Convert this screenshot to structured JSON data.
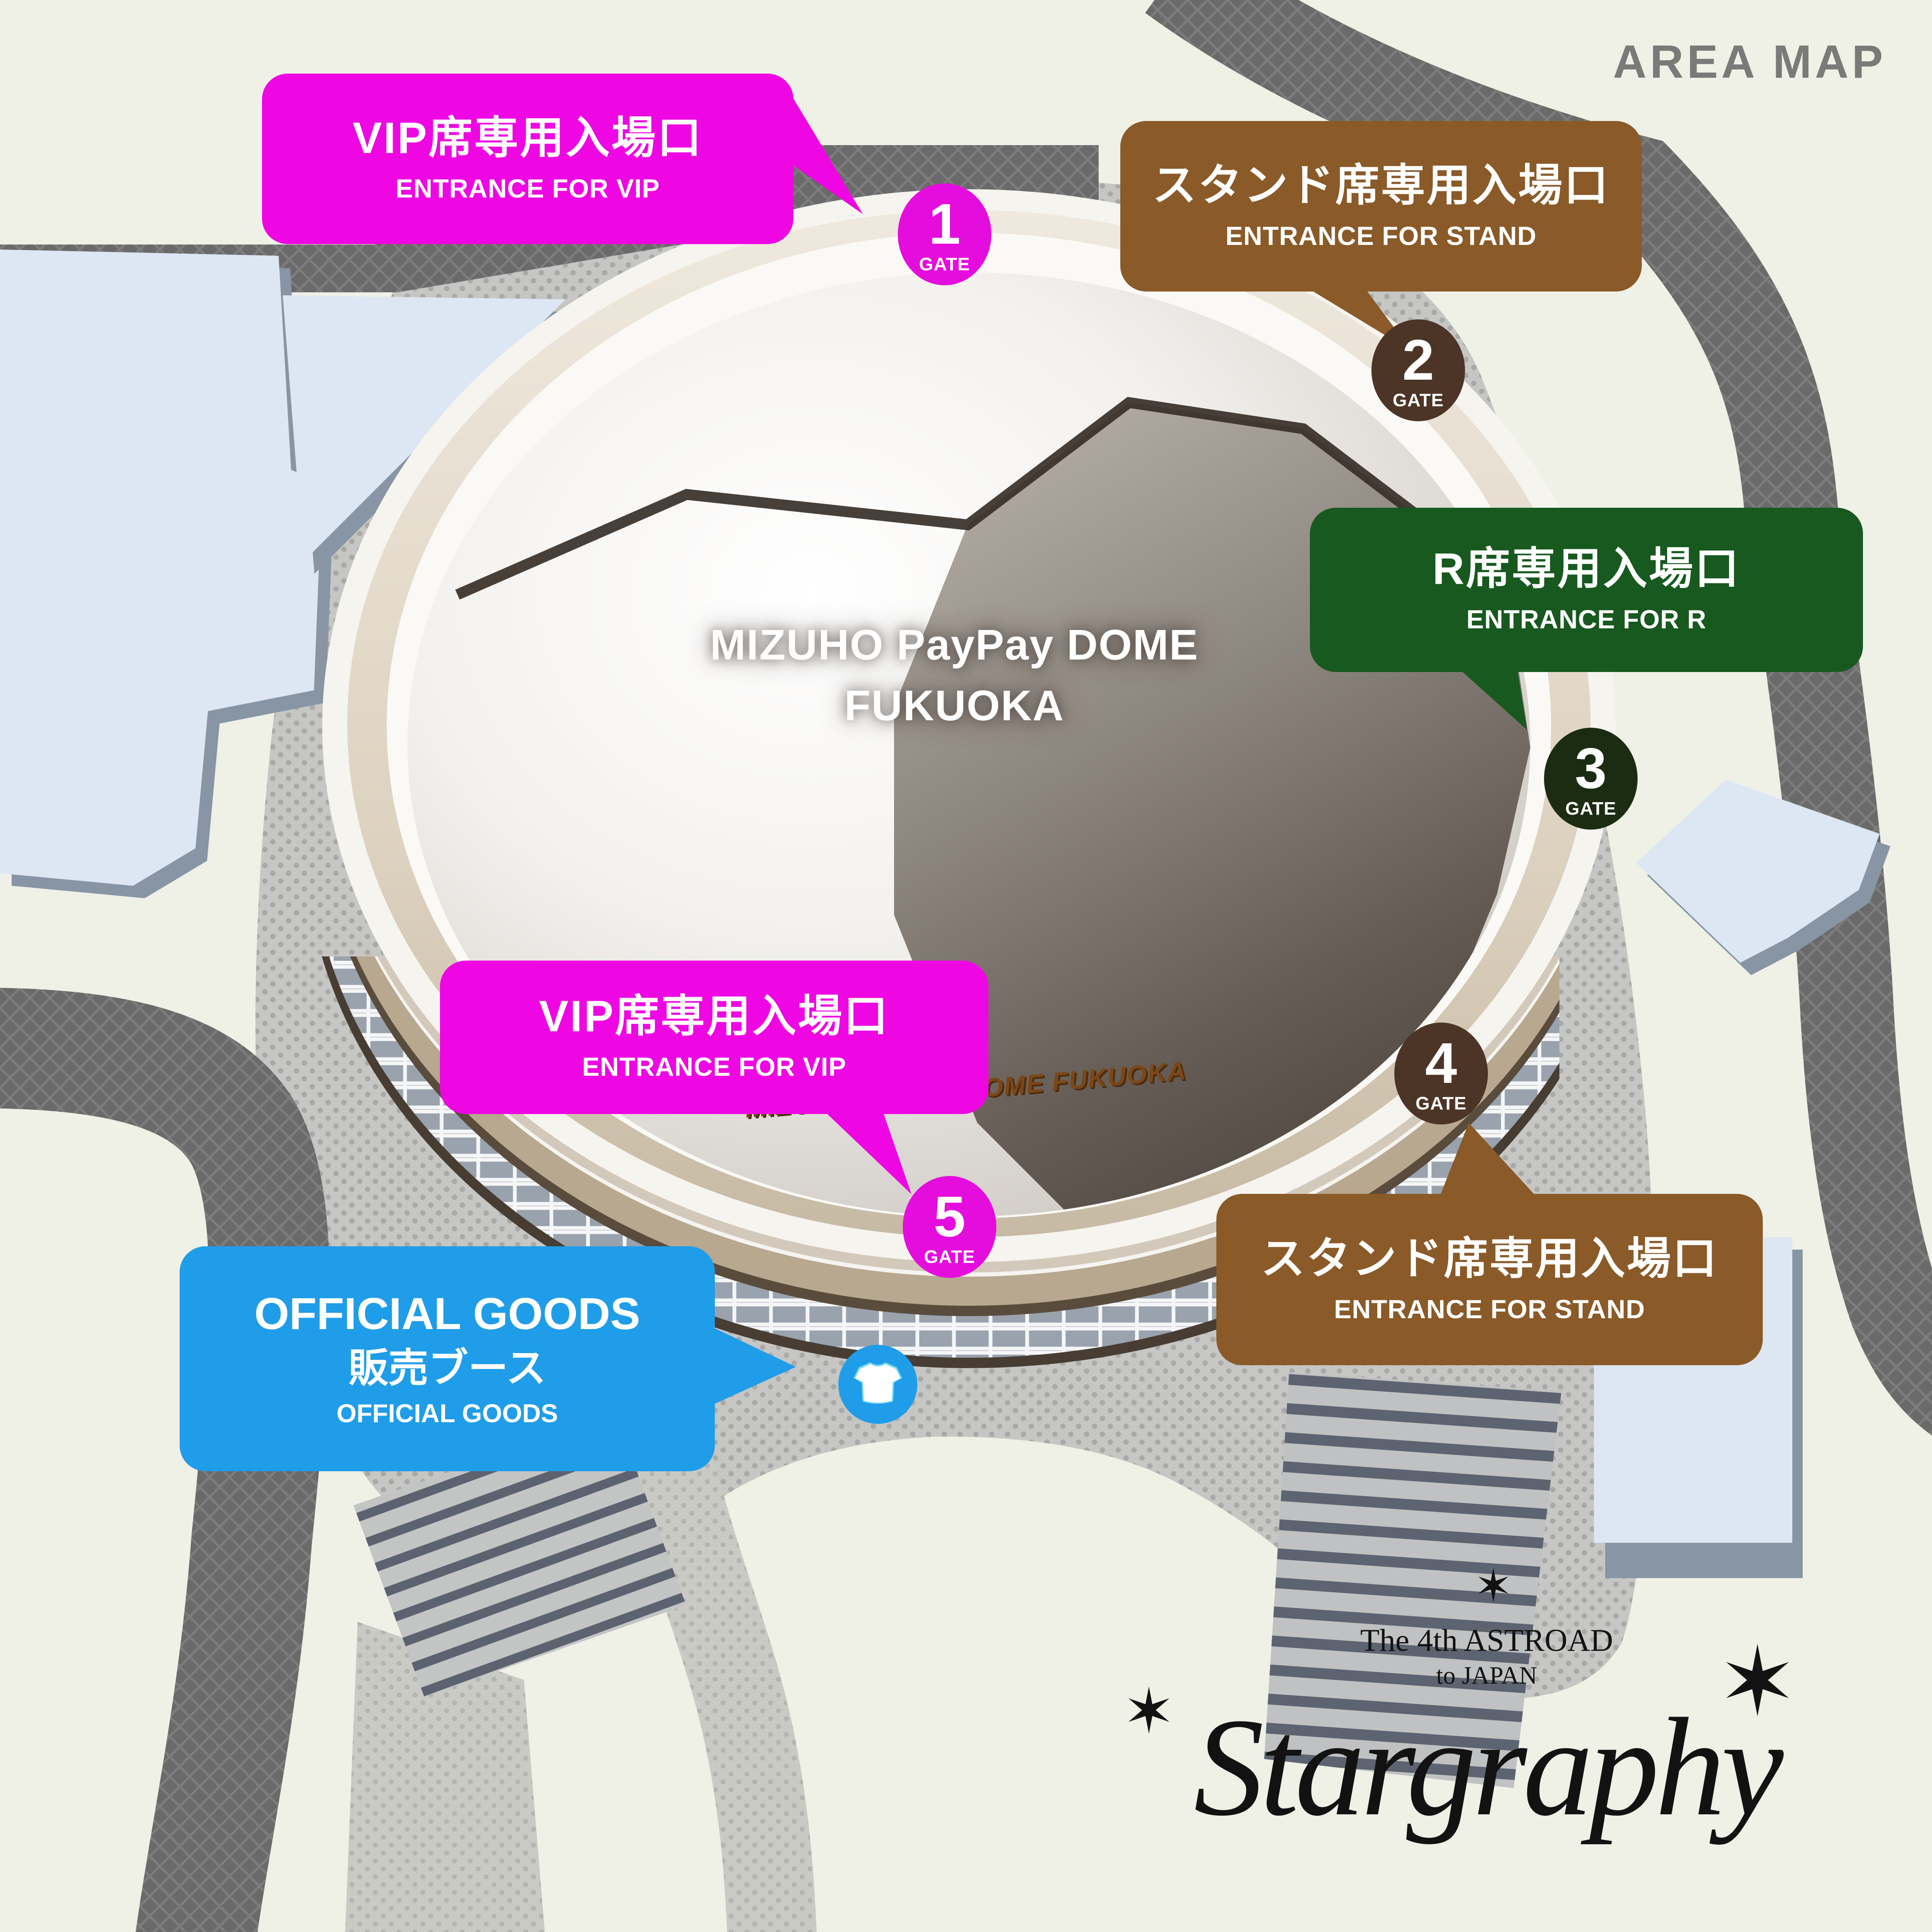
{
  "title": "AREA MAP",
  "dome": {
    "name_line1": "MIZUHO PayPay DOME",
    "name_line2": "FUKUOKA",
    "signage": "MIZUHO PayPay DOME FUKUOKA"
  },
  "callouts": {
    "vip_top": {
      "jp": "VIP席専用入場口",
      "en": "ENTRANCE FOR VIP",
      "color": "#ee07e2"
    },
    "stand_top": {
      "jp": "スタンド席専用入場口",
      "en": "ENTRANCE FOR STAND",
      "color": "#8a5a28"
    },
    "r_side": {
      "jp": "R席専用入場口",
      "en": "ENTRANCE FOR R",
      "color": "#17591f"
    },
    "vip_bottom": {
      "jp": "VIP席専用入場口",
      "en": "ENTRANCE FOR VIP",
      "color": "#ee07e2"
    },
    "stand_bottom": {
      "jp": "スタンド席専用入場口",
      "en": "ENTRANCE FOR STAND",
      "color": "#8a5a28"
    },
    "goods": {
      "en_top": "OFFICIAL GOODS",
      "jp": "販売ブース",
      "en_bottom": "OFFICIAL GOODS",
      "color": "#1f9de9"
    }
  },
  "gates": {
    "g1": {
      "number": "1",
      "label": "GATE",
      "color": "#e40ddd"
    },
    "g2": {
      "number": "2",
      "label": "GATE",
      "color": "#4c3526"
    },
    "g3": {
      "number": "3",
      "label": "GATE",
      "color": "#1c2c12"
    },
    "g4": {
      "number": "4",
      "label": "GATE",
      "color": "#4c3526"
    },
    "g5": {
      "number": "5",
      "label": "GATE",
      "color": "#e40ddd"
    }
  },
  "logo": {
    "line1": "The 4th ASTROAD",
    "line2": "to JAPAN",
    "name": "Stargraphy"
  },
  "icons": {
    "tshirt": "t-shirt-icon"
  }
}
